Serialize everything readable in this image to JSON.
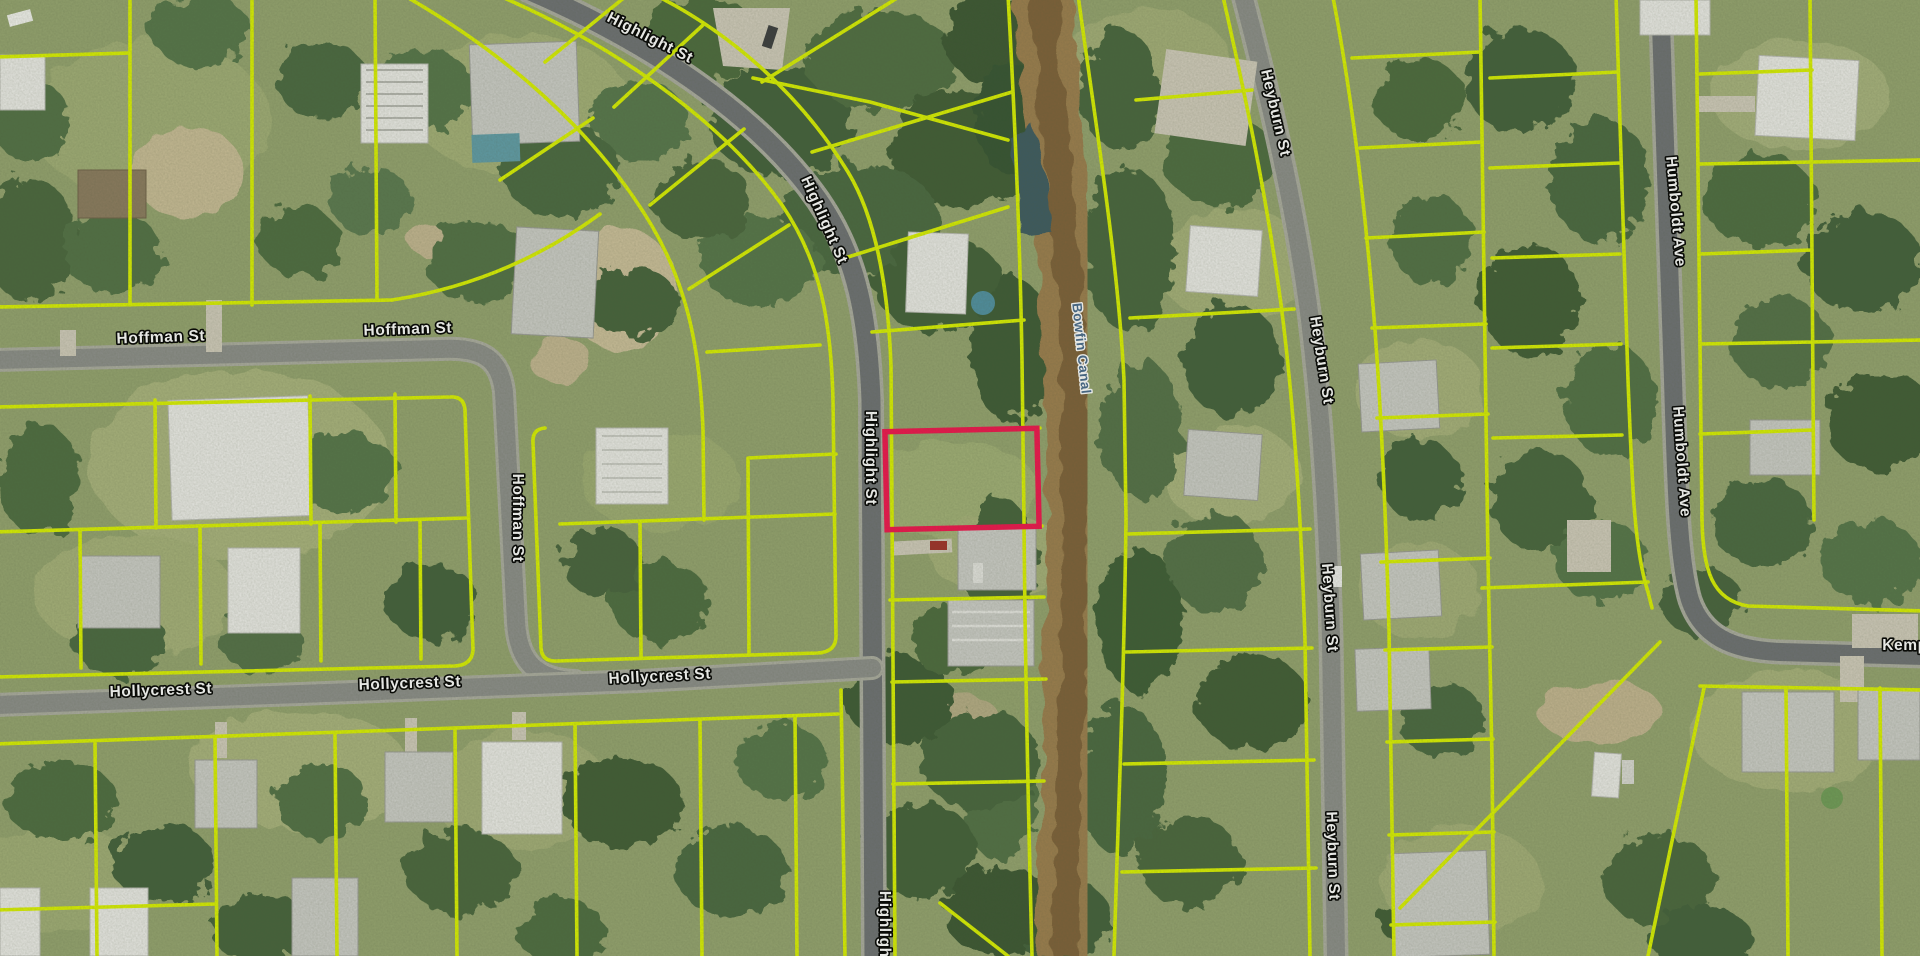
{
  "map": {
    "title": "Aerial parcel map with highlighted lot",
    "streets": [
      "Highlight St",
      "Hoffman St",
      "Hollycrest St",
      "Heyburn St",
      "Humboldt Ave",
      "Kemp"
    ],
    "waterway": "Bowfin Canal",
    "colors": {
      "parcel_line": "#d9f000",
      "highlight_parcel": "#f0134d",
      "street_label_fill": "#ffffff",
      "street_label_halo": "#000000",
      "canal_label_fill": "#46688c",
      "canal_label_halo": "#ffffff"
    },
    "street_labels": [
      {
        "text": "Highlight St",
        "x": 648,
        "y": 42,
        "rot": 27
      },
      {
        "text": "Highlight St",
        "x": 820,
        "y": 222,
        "rot": 66
      },
      {
        "text": "Highlight St",
        "x": 866,
        "y": 458,
        "rot": 90
      },
      {
        "text": "Highlight St",
        "x": 880,
        "y": 938,
        "rot": 90
      },
      {
        "text": "Hoffman St",
        "x": 161,
        "y": 342,
        "rot": -2
      },
      {
        "text": "Hoffman St",
        "x": 408,
        "y": 334,
        "rot": -2
      },
      {
        "text": "Hoffman St",
        "x": 513,
        "y": 518,
        "rot": 90
      },
      {
        "text": "Hollycrest St",
        "x": 161,
        "y": 695,
        "rot": -2
      },
      {
        "text": "Hollycrest St",
        "x": 410,
        "y": 688,
        "rot": -2
      },
      {
        "text": "Hollycrest St",
        "x": 660,
        "y": 681,
        "rot": -3
      },
      {
        "text": "Heyburn St",
        "x": 1271,
        "y": 114,
        "rot": 77
      },
      {
        "text": "Heyburn St",
        "x": 1317,
        "y": 361,
        "rot": 81
      },
      {
        "text": "Heyburn St",
        "x": 1325,
        "y": 608,
        "rot": 86
      },
      {
        "text": "Heyburn St",
        "x": 1328,
        "y": 856,
        "rot": 88
      },
      {
        "text": "Humboldt Ave",
        "x": 1671,
        "y": 212,
        "rot": 85
      },
      {
        "text": "Humboldt Ave",
        "x": 1677,
        "y": 462,
        "rot": 86
      },
      {
        "text": "Kemp",
        "x": 1905,
        "y": 650,
        "rot": 0
      }
    ],
    "canal_label": {
      "text": "Bowfin Canal",
      "x": 1077,
      "y": 349,
      "rot": 84
    },
    "highlighted_parcel": {
      "x": 886,
      "y": 430,
      "width": 152,
      "height": 98,
      "rotation": -1.3,
      "stroke_width": 5.5
    }
  }
}
